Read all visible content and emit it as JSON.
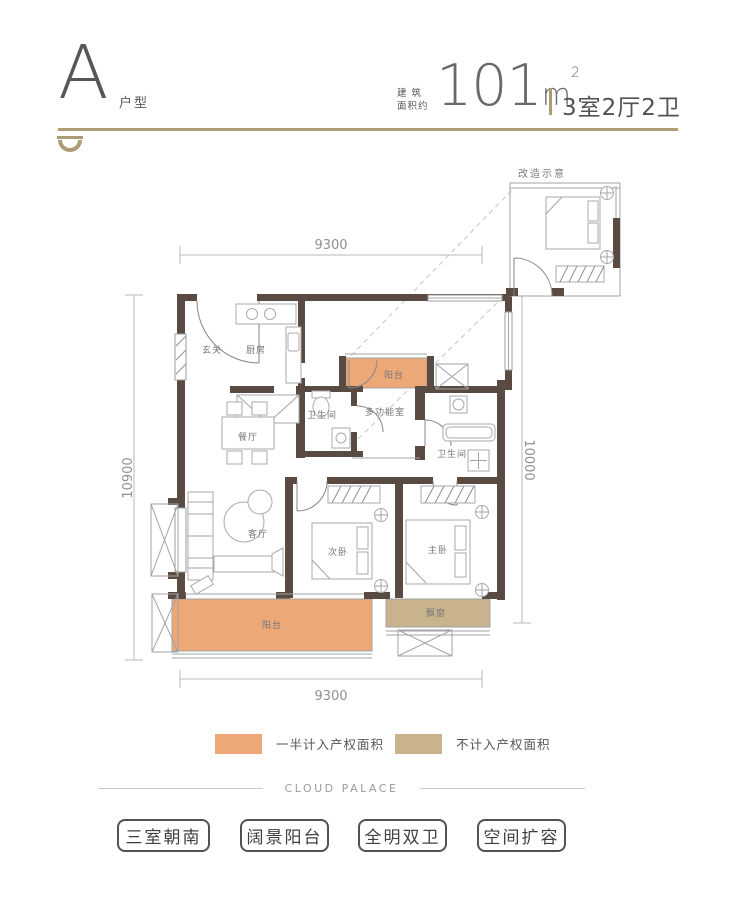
{
  "header": {
    "unit_letter": "A",
    "unit_type": "户型",
    "area_prefix_line1": "建 筑",
    "area_prefix_line2": "面积约",
    "area_value": "101",
    "area_unit": "m",
    "area_exponent": "2",
    "layout_spec": "3室2厅2卫"
  },
  "plan": {
    "dim_top": "9300",
    "dim_bottom": "9300",
    "dim_left": "10900",
    "dim_right": "10000",
    "rooms": {
      "entry": "玄关",
      "kitchen": "厨房",
      "dining": "餐厅",
      "bath_left": "卫生间",
      "multi_room": "多功能室",
      "balcony_top": "阳台",
      "bath_right": "卫生间",
      "living": "客厅",
      "bedroom_second": "次卧",
      "bedroom_master": "主卧",
      "balcony_main": "阳台",
      "bay_window": "飘窗"
    },
    "inset_title": "改造示意"
  },
  "legend": {
    "items": [
      {
        "label": "一半计入产权面积",
        "color": "#eda878"
      },
      {
        "label": "不计入产权面积",
        "color": "#c9b38c"
      }
    ]
  },
  "footer": {
    "brand": "CLOUD PALACE",
    "tags": [
      "三室朝南",
      "阔景阳台",
      "全明双卫",
      "空间扩容"
    ]
  },
  "colors": {
    "accent_gold": "#ab9c73",
    "wall": "#594a42",
    "zone_half": "#eda878",
    "zone_none": "#c9b38c"
  }
}
